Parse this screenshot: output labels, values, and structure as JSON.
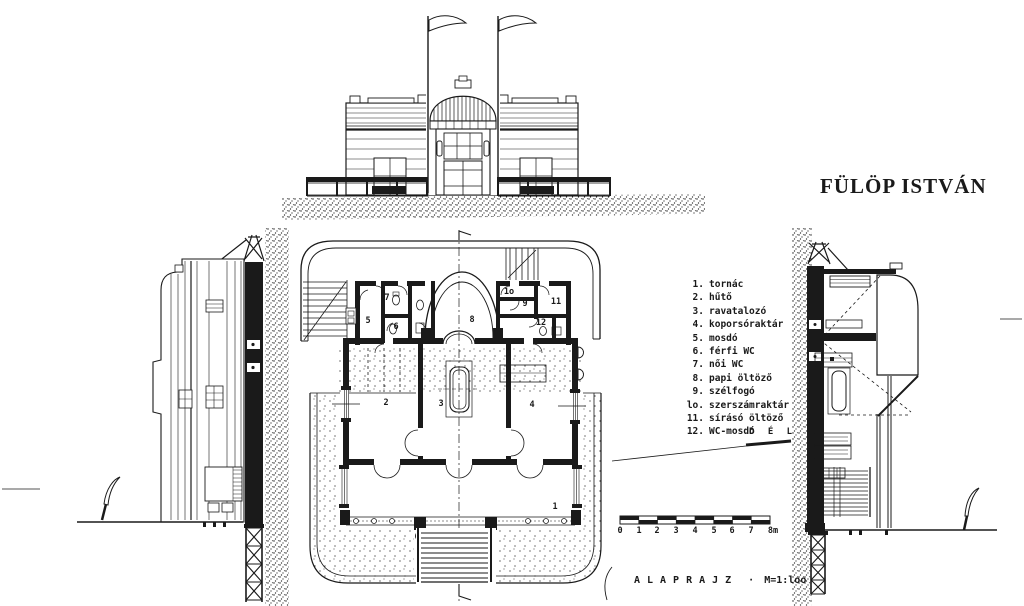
{
  "title": "FÜLÖP ISTVÁN",
  "legend": {
    "items": [
      {
        "num": "1.",
        "label": "tornác"
      },
      {
        "num": "2.",
        "label": "hűtő"
      },
      {
        "num": "3.",
        "label": "ravatalozó"
      },
      {
        "num": "4.",
        "label": "koporsóraktár"
      },
      {
        "num": "5.",
        "label": "mosdó"
      },
      {
        "num": "6.",
        "label": "férfi WC"
      },
      {
        "num": "7.",
        "label": "női WC"
      },
      {
        "num": "8.",
        "label": "papi öltöző"
      },
      {
        "num": "9.",
        "label": "szélfogó"
      },
      {
        "num": "lo.",
        "label": "szerszámraktár"
      },
      {
        "num": "11.",
        "label": "sírásó öltöző"
      },
      {
        "num": "12.",
        "label": "WC-mosdó"
      }
    ]
  },
  "plan_rooms": {
    "r1": "1",
    "r2": "2",
    "r3": "3",
    "r4": "4",
    "r5": "5",
    "r6": "6",
    "r7": "7",
    "r8": "8",
    "r9": "9",
    "r10": "1o",
    "r11": "11",
    "r12": "12"
  },
  "south_label": "D É L",
  "scale_bar": {
    "ticks": [
      "0",
      "1",
      "2",
      "3",
      "4",
      "5",
      "6",
      "7",
      "8m"
    ]
  },
  "caption": {
    "plan_label": "ALAPRAJZ",
    "separator": "·",
    "scale": "M=1:loo"
  },
  "colors": {
    "ink": "#1a1a1a",
    "paper": "#ffffff"
  }
}
